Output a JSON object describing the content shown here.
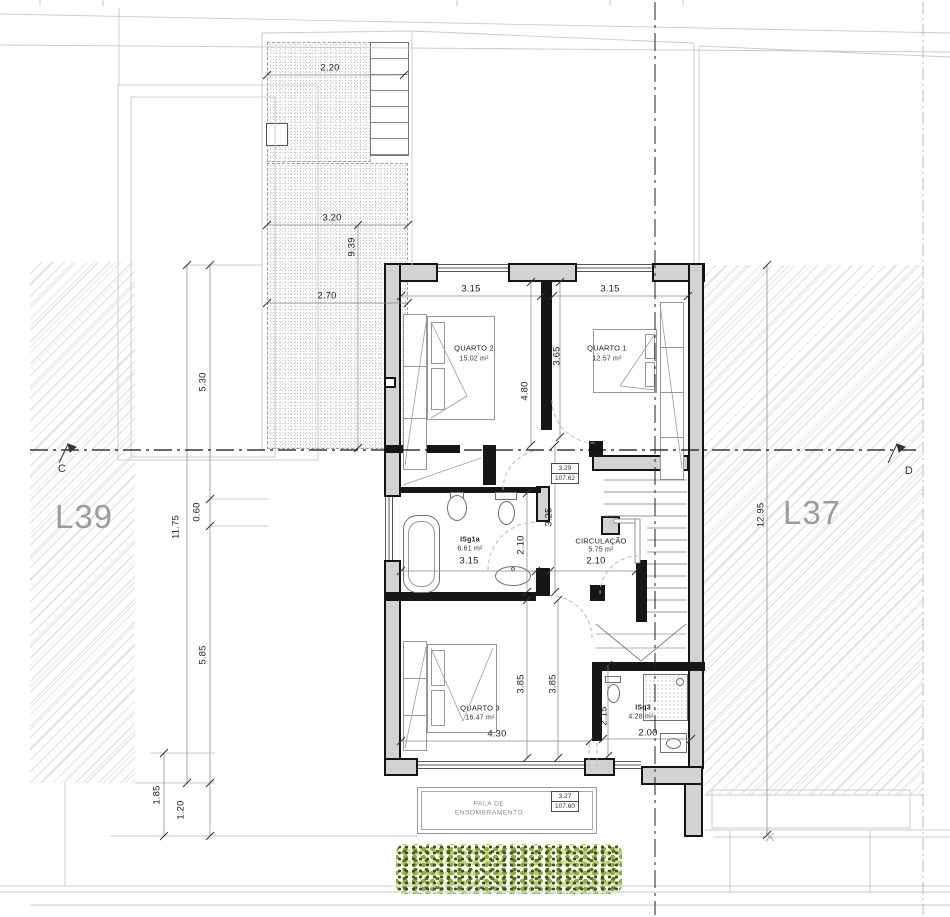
{
  "drawing": {
    "parcel_left": "L39",
    "parcel_right": "L37",
    "section_left": "C",
    "section_right": "D"
  },
  "rooms": {
    "q1": {
      "name": "QUARTO 1",
      "area": "12.57 m²"
    },
    "q2": {
      "name": "QUARTO 2",
      "area": "15.02 m²"
    },
    "q3": {
      "name": "QUARTO 3",
      "area": "16.47 m²"
    },
    "isg1a": {
      "name": "ISg1a",
      "area": "6.61 m²"
    },
    "circulacao": {
      "name": "CIRCULAÇÃO",
      "area": "5.75 m²"
    },
    "isq3": {
      "name": "ISq3",
      "area": "4.28 m²"
    }
  },
  "dims": {
    "patio_top": "2.20",
    "patio_mid": "3.20",
    "patio_depth": "9.39",
    "patio_low": "2.70",
    "left_a": "5.30",
    "left_b": "0.60",
    "left_c": "5.85",
    "left_total": "11.75",
    "left_d": "1.85",
    "left_e": "1.20",
    "right_total": "12.95",
    "q2_w": "3.15",
    "q2_h": "4.80",
    "q1_w": "3.15",
    "q1_h": "3.65",
    "isg_w": "3.15",
    "isg_h": "2.10",
    "hall_h": "3.25",
    "cor_w": "2.10",
    "q3_w": "4.30",
    "q3_h1": "3.85",
    "q3_h2": "3.85",
    "isq_h": "2.15",
    "isq_w": "2.00"
  },
  "levels": {
    "circ": {
      "rel": "3.29",
      "abs": "107.62"
    },
    "pala": {
      "rel": "3.27",
      "abs": "107.60"
    }
  },
  "pala": {
    "line1": "PALA DE",
    "line2": "ENSOMBRAMENTO"
  }
}
